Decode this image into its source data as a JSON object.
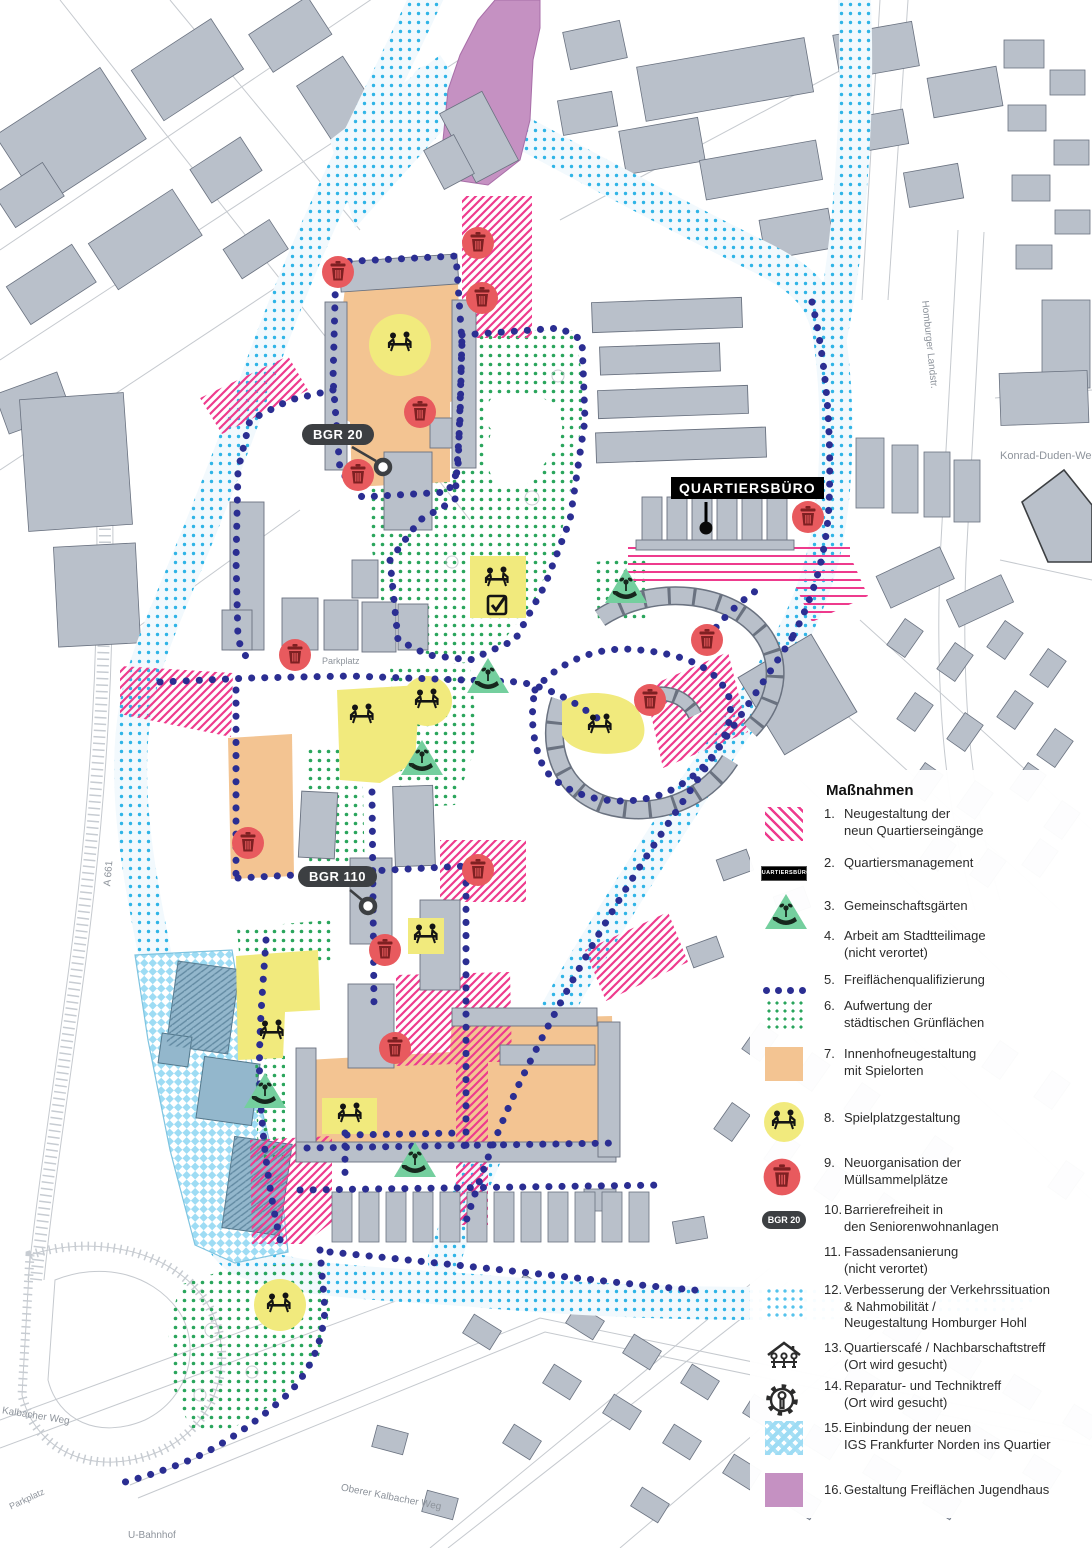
{
  "map": {
    "labels": {
      "bgr20": "BGR 20",
      "bgr110": "BGR 110",
      "quartiersbuero": "QUARTIERSBÜRO",
      "parkplatz": "Parkplatz",
      "u_bahnhof": "U-Bahnhof",
      "a661": "A 661",
      "konrad_duden_weg": "Konrad-Duden-Weg",
      "homburger_landstr": "Homburger Landstr.",
      "oberer_kalbacher_weg": "Oberer Kalbacher Weg"
    },
    "colors": {
      "quarter_boundary_navy": "#2b2e92",
      "traffic_cyan_dots": "#2fb4e6",
      "green_dots": "#2aa55c",
      "entrance_pink": "#ee3b8d",
      "courtyard_orange": "#f3c492",
      "playground_yellow": "#f1ea7d",
      "waste_red": "#e85a5e",
      "garden_triangle_green": "#74cf9e",
      "jugendhaus_purple": "#c591c2",
      "igs_blue": "#9edcf4",
      "building_gray": "#b9c0ca"
    }
  },
  "legend": {
    "title": "Maßnahmen",
    "items": [
      {
        "num": "1.",
        "lines": [
          "Neugestaltung der",
          "neun Quartierseingänge"
        ]
      },
      {
        "num": "2.",
        "lines": [
          "Quartiersmanagement"
        ],
        "swatch_text": "QUARTIERSBÜRO"
      },
      {
        "num": "3.",
        "lines": [
          "Gemeinschaftsgärten"
        ]
      },
      {
        "num": "4.",
        "lines": [
          "Arbeit am Stadtteilimage",
          "(nicht verortet)"
        ]
      },
      {
        "num": "5.",
        "lines": [
          "Freiflächenqualifizierung"
        ]
      },
      {
        "num": "6.",
        "lines": [
          "Aufwertung der",
          "städtischen Grünflächen"
        ]
      },
      {
        "num": "7.",
        "lines": [
          "Innenhofneugestaltung",
          "mit Spielorten"
        ]
      },
      {
        "num": "8.",
        "lines": [
          "Spielplatzgestaltung"
        ]
      },
      {
        "num": "9.",
        "lines": [
          "Neuorganisation der",
          "Müllsammelplätze"
        ]
      },
      {
        "num": "10.",
        "lines": [
          "Barrierefreiheit in",
          "den Seniorenwohnanlagen"
        ],
        "swatch_text": "BGR 20"
      },
      {
        "num": "11.",
        "lines": [
          "Fassadensanierung",
          "(nicht verortet)"
        ]
      },
      {
        "num": "12.",
        "lines": [
          "Verbesserung der Verkehrssituation",
          "& Nahmobilität /",
          "Neugestaltung Homburger Hohl"
        ]
      },
      {
        "num": "13.",
        "lines": [
          "Quartierscafé / Nachbarschaftstreff",
          "(Ort wird gesucht)"
        ]
      },
      {
        "num": "14.",
        "lines": [
          "Reparatur- und Techniktreff",
          "(Ort wird gesucht)"
        ]
      },
      {
        "num": "15.",
        "lines": [
          "Einbindung der neuen",
          "IGS Frankfurter Norden ins Quartier"
        ]
      },
      {
        "num": "16.",
        "lines": [
          "Gestaltung Freiflächen Jugendhaus"
        ]
      }
    ]
  }
}
